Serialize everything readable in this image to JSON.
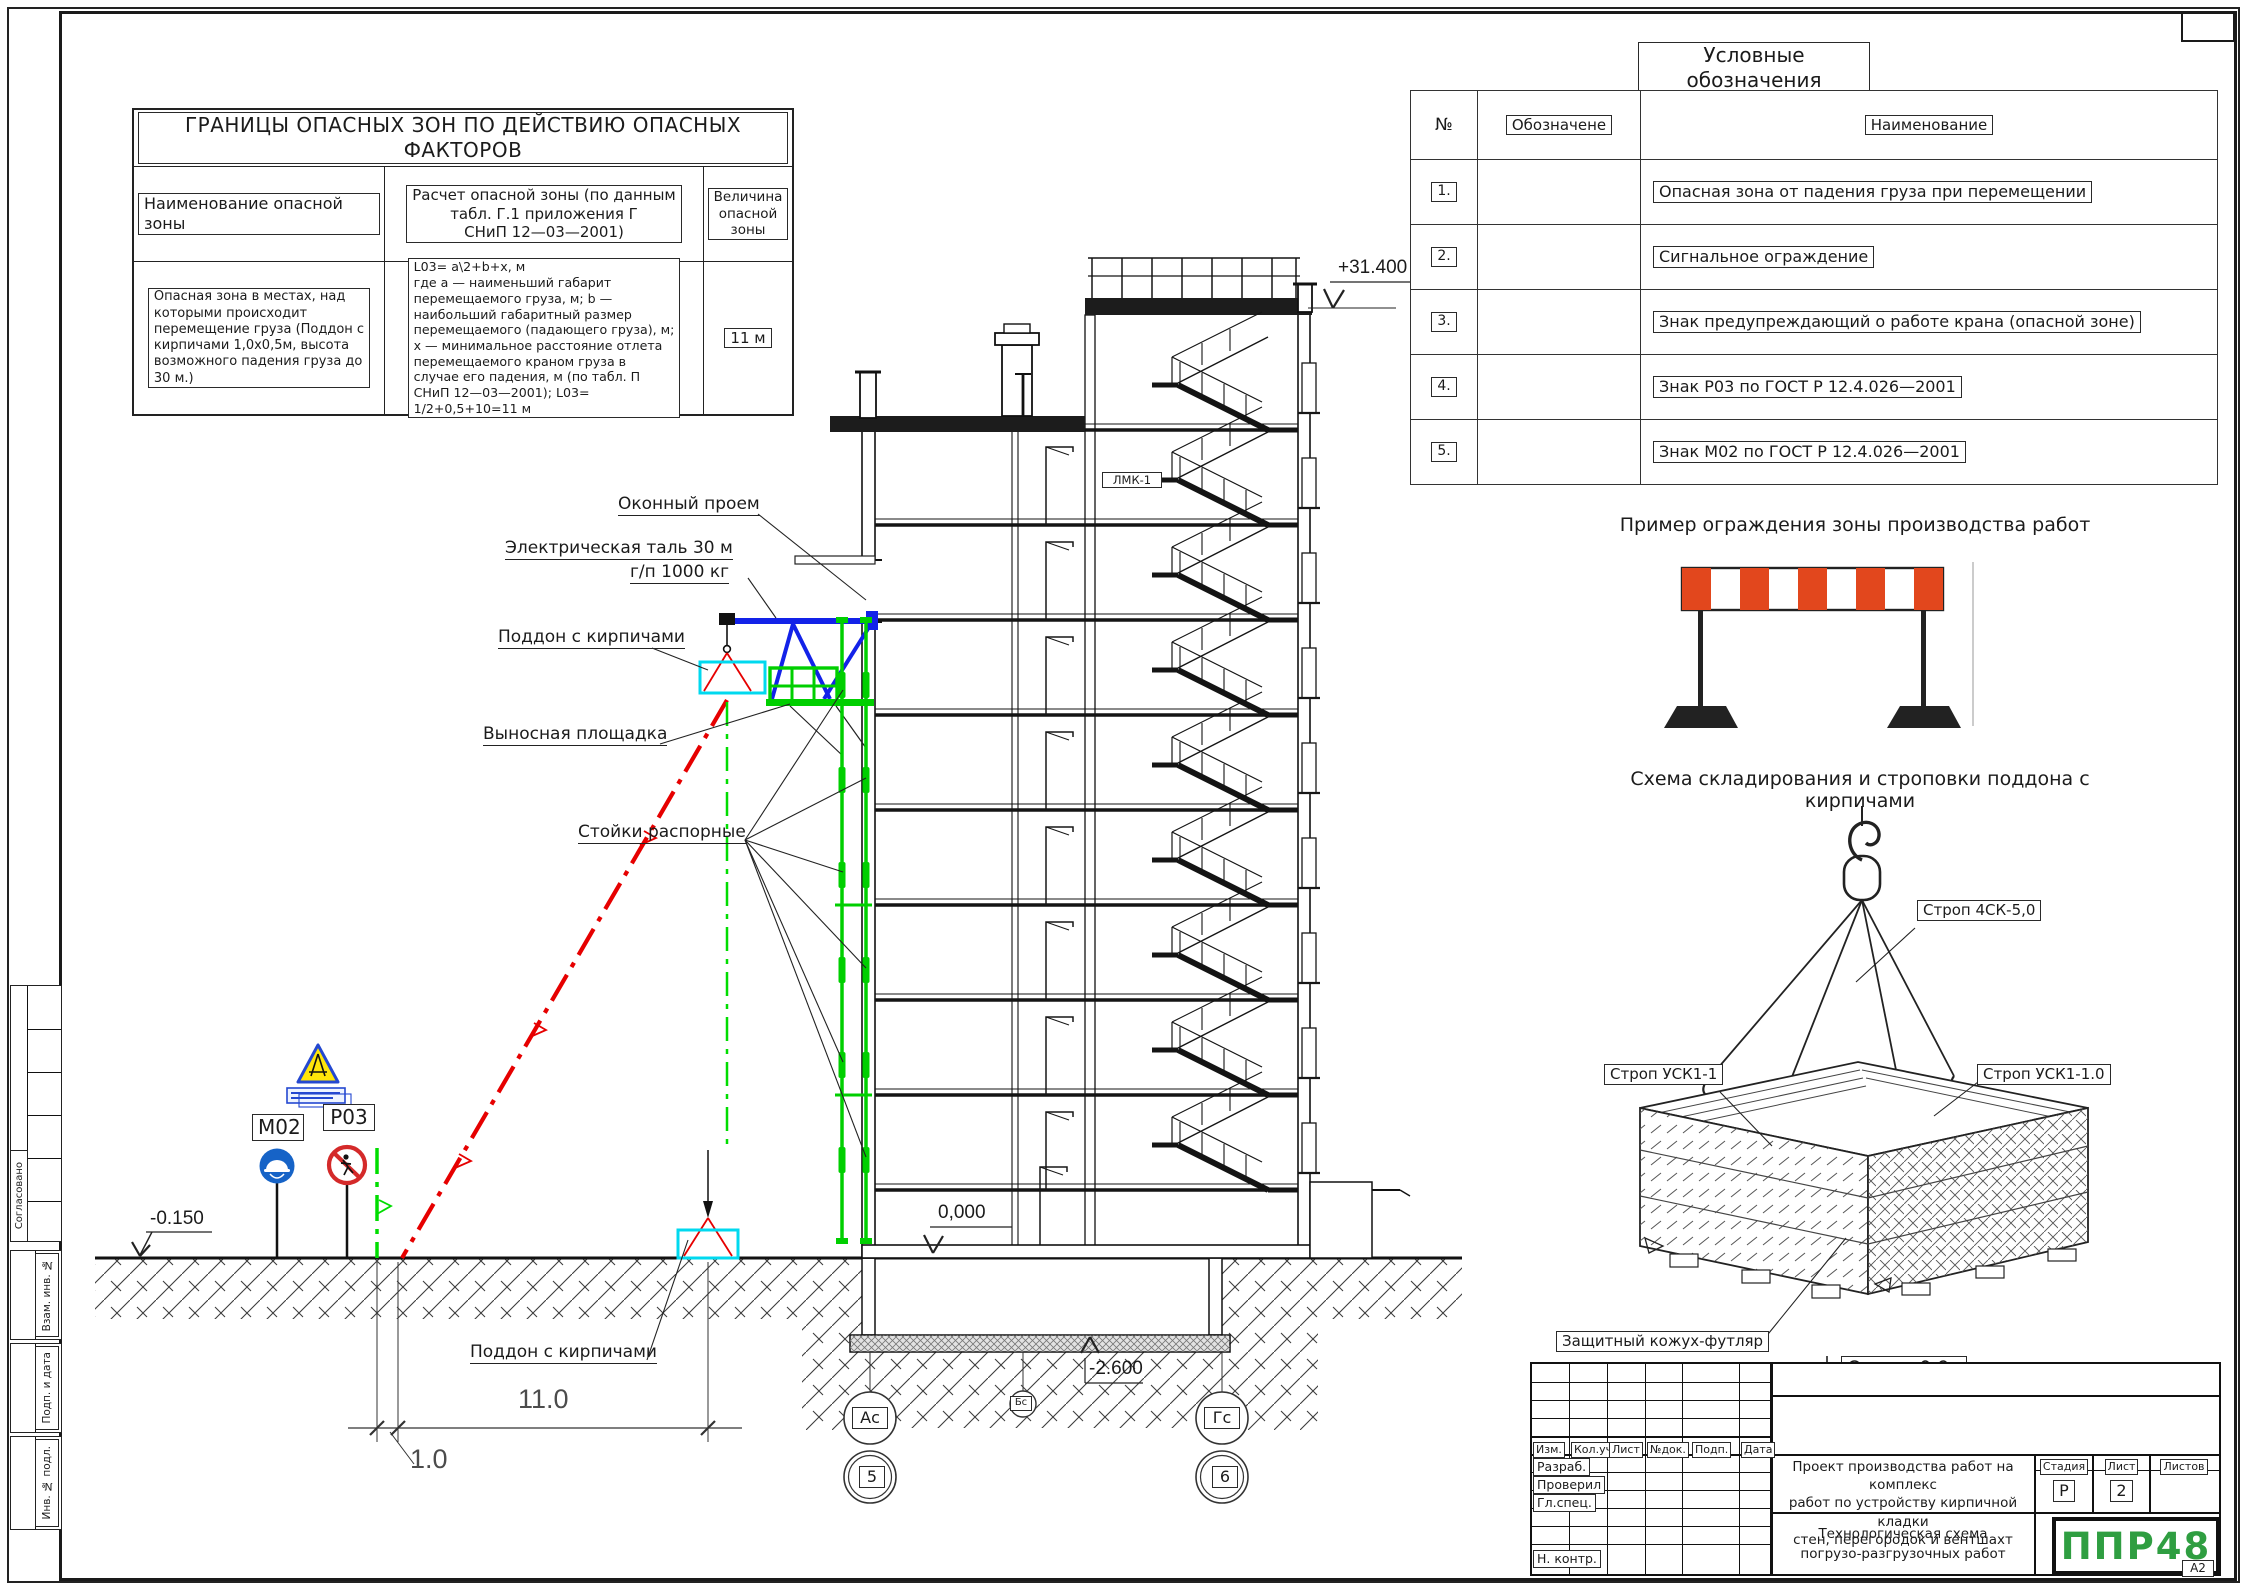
{
  "sheet": {
    "format_label": "А2"
  },
  "margins": {
    "approved": "Согласовано",
    "vzam": "Взам. инв. №",
    "podp": "Подп. и дата",
    "inv": "Инв. № подл."
  },
  "danger_table": {
    "title": "ГРАНИЦЫ  ОПАСНЫХ  ЗОН  ПО  ДЕЙСТВИЮ  ОПАСНЫХ  ФАКТОРОВ",
    "col1_header": "Наименование опасной зоны",
    "col2_header": "Расчет опасной зоны (по данным\nтабл. Г.1 приложения Г\nСНиП 12—03—2001)",
    "col3_header": "Величина опасной зоны",
    "col1_body": "Опасная зона в местах, над\nкоторыми происходит\nперемещение груза (Поддон с\nкирпичами 1,0х0,5м, высота\nвозможного падения груза до\n30 м.)",
    "col2_body": "L03=  a\\2+b+x,  м\nгде a — наименьший габарит\nперемещаемого груза, м;  b —\nнаибольший габаритный размер\nперемещаемого (падающего груза), м;\nx —  минимальное расстояние отлета\nперемещаемого краном груза в\nслучае его падения, м (по табл. П\nСНиП 12—03—2001);  L03=\n1/2+0,5+10=11  м",
    "col3_body": "11 м"
  },
  "legend": {
    "title": "Условные обозначения",
    "col_num": "№",
    "col_sym": "Обозначене",
    "col_name": "Наименование",
    "rows": [
      {
        "num": "1.",
        "name": "Опасная зона от падения груза при перемещении"
      },
      {
        "num": "2.",
        "name": "Сигнальное ограждение"
      },
      {
        "num": "3.",
        "name": "Знак предупреждающий о работе крана (опасной зоне)"
      },
      {
        "num": "4.",
        "name": "Знак Р03  по ГОСТ Р 12.4.026—2001"
      },
      {
        "num": "5.",
        "name": "Знак М02  по ГОСТ Р 12.4.026—2001"
      }
    ]
  },
  "fence": {
    "title": "Пример ограждения зоны производства работ"
  },
  "sling": {
    "title": "Схема складирования и строповки поддона с кирпичами",
    "strop_main": "Строп 4СК-5,0",
    "strop_left": "Строп УСК1-1",
    "strop_right": "Строп УСК1-1.0",
    "cover": "Защитный кожух-футляр",
    "qmax": "Qmax=0,9т"
  },
  "section": {
    "label_window": "Оконный проем",
    "label_hoist_1": "Электрическая таль 30 м",
    "label_hoist_2": "г/п 1000 кг",
    "label_pallet_up": "Поддон с кирпичами",
    "label_platform": "Выносная площадка",
    "label_posts": "Стойки распорные",
    "label_pallet_down": "Поддон с кирпичами",
    "sign_m02": "М02",
    "sign_p03": "Р03",
    "lmk": "ЛМК-1",
    "elev_top": "+31.400",
    "elev_zero": "0,000",
    "elev_base": "-2.600",
    "elev_ground": "-0.150",
    "dim_main": "11.0",
    "dim_offset": "1.0",
    "axis_a": "Ас",
    "axis_b": "Бс",
    "axis_g": "Гс",
    "axis_5": "5",
    "axis_6": "6"
  },
  "titleblock": {
    "col_izm": "Изм.",
    "col_koluch": "Кол.уч.",
    "col_list": "Лист",
    "col_ndok": "№док.",
    "col_podp": "Подп.",
    "col_data": "Дата",
    "row_razrab": "Разраб.",
    "row_proveril": "Проверил",
    "row_glspec": "Гл.спец.",
    "row_nkontr": "Н. контр.",
    "project": "Проект производства работ на комплекс\nработ по устройству кирпичной кладки\nстен, перегородок и вентшахт",
    "doc_title": "Технологическая схема\nпогрузо-разгрузочных работ",
    "stage_label": "Стадия",
    "sheet_label": "Лист",
    "sheets_label": "Листов",
    "stage_value": "Р",
    "sheet_value": "2",
    "logo": "ППР48"
  }
}
